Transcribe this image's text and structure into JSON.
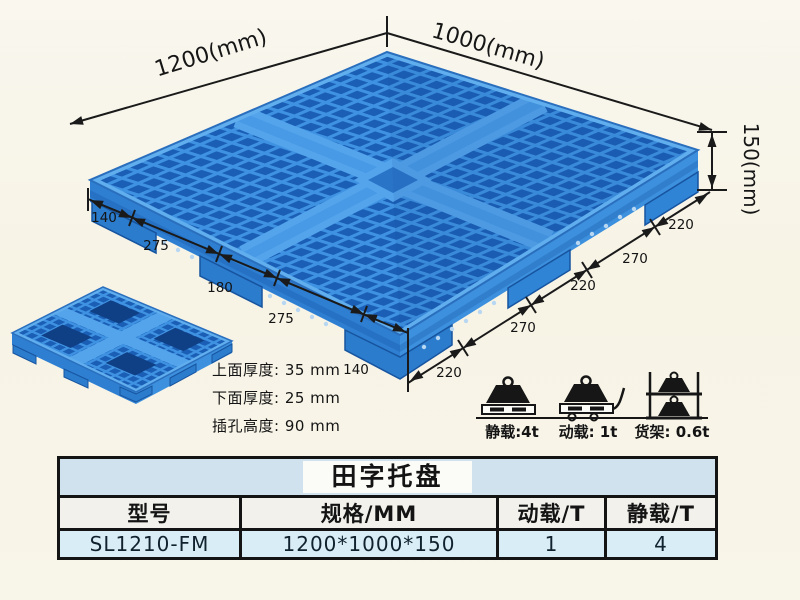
{
  "page": {
    "background": "#f8f5e9"
  },
  "pallet": {
    "name": "田字托盘",
    "width_label": "1200(mm)",
    "depth_label": "1000(mm)",
    "height_label": "150(mm)",
    "left_dims": [
      "140",
      "275",
      "180",
      "275",
      "140"
    ],
    "right_dims": [
      "220",
      "270",
      "220",
      "270",
      "220"
    ],
    "thickness_notes": [
      "上面厚度: 35 mm",
      "下面厚度: 25 mm",
      "插孔高度: 90 mm"
    ],
    "load_ratings": [
      {
        "icon": "static-load-icon",
        "label": "静载:4t"
      },
      {
        "icon": "dynamic-load-icon",
        "label": "动载: 1t"
      },
      {
        "icon": "rack-load-icon",
        "label": "货架: 0.6t"
      }
    ],
    "colors": {
      "rib_blue": "#3f92e2",
      "hole_blue": "#1a5fb5",
      "highlight_blue": "#61aeee",
      "skirt_blue": "#2e7fd2",
      "ink": "#1a1a1a"
    }
  },
  "spec_table": {
    "title": "田字托盘",
    "headers": [
      "型号",
      "规格/MM",
      "动载/T",
      "静载/T"
    ],
    "rows": [
      [
        "SL1210-FM",
        "1200*1000*150",
        "1",
        "4"
      ]
    ],
    "colors": {
      "title_bg": "#cfe2ee",
      "header_bg": "#f2f1ec",
      "data_bg": "#d9edf6"
    }
  }
}
